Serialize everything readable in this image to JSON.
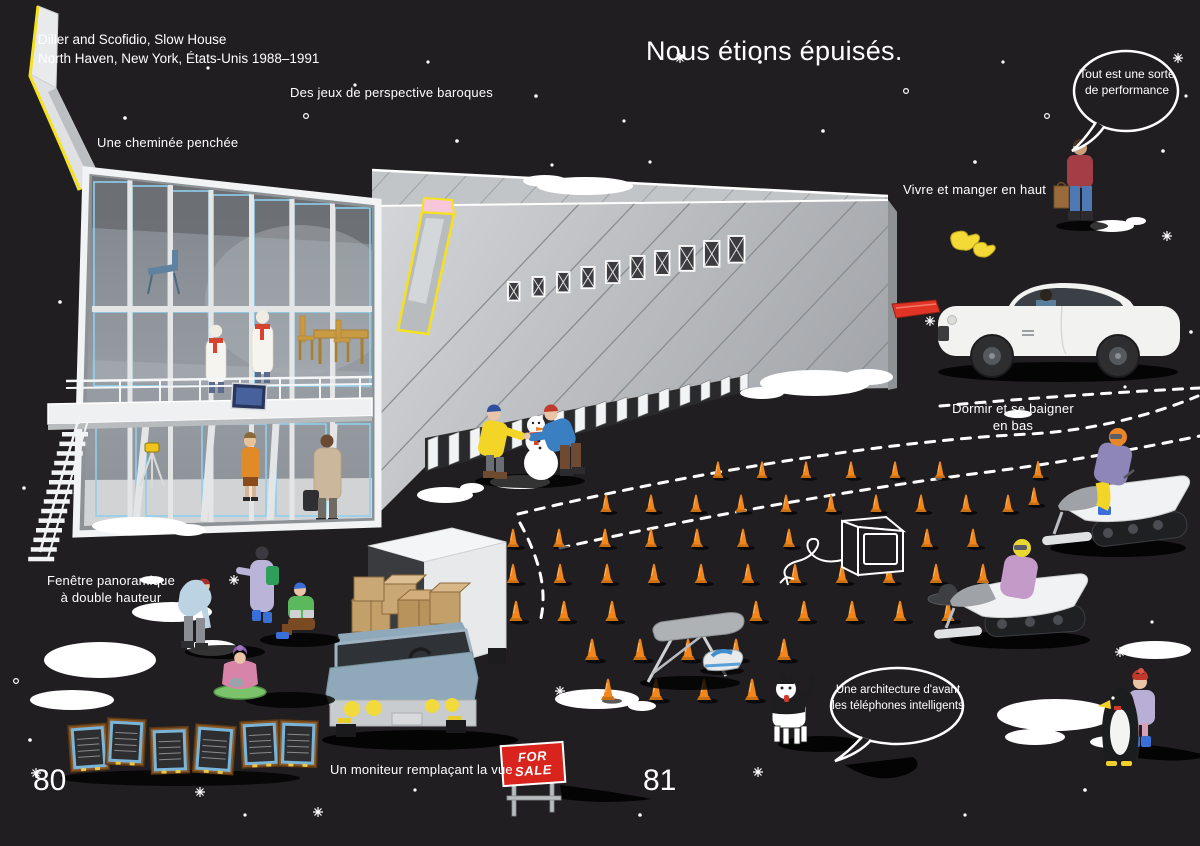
{
  "colors": {
    "background": "#211e21",
    "text": "#ffffff",
    "cone_orange": "#f0861c",
    "sign_red": "#d8241c",
    "accent_yellow": "#f6e11d",
    "snow_white": "#ffffff"
  },
  "page_numbers": {
    "left": "80",
    "right": "81"
  },
  "title": "Nous étions épuisés.",
  "credit": {
    "line1": "Diller and Scofidio, Slow House",
    "line2": "North Haven, New York, États-Unis 1988–1991"
  },
  "annotations": {
    "baroque": "Des jeux de perspective baroques",
    "chimney": "Une cheminée penchée",
    "upstairs": "Vivre et manger en haut",
    "downstairs_line1": "Dormir et se baigner",
    "downstairs_line2": "en bas",
    "window_line1": "Fenêtre panoramique",
    "window_line2": "à double hauteur",
    "monitor": "Un moniteur remplaçant la vue"
  },
  "speech_bubbles": {
    "performance": "Tout est une sorte de performance",
    "architecture": "Une architecture d'avant les téléphones intelligents"
  },
  "for_sale_sign": {
    "line1": "FOR",
    "line2": "SALE"
  }
}
